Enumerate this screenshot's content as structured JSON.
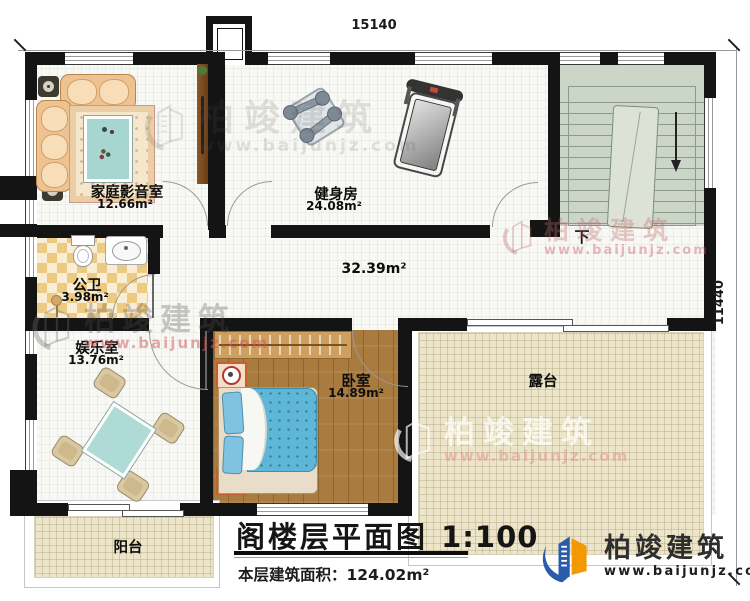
{
  "dimensions": {
    "top": "15140",
    "right": "11440"
  },
  "rooms": {
    "theater": {
      "name": "家庭影音室",
      "area": "12.66m²"
    },
    "gym": {
      "name": "健身房",
      "area": "24.08m²"
    },
    "bath": {
      "name": "公卫",
      "area": "3.98m²"
    },
    "play": {
      "name": "娱乐室",
      "area": "13.76m²"
    },
    "bedroom": {
      "name": "卧室",
      "area": "14.89m²"
    },
    "terrace": {
      "name": "露台"
    },
    "balcony": {
      "name": "阳台"
    },
    "hall": {
      "area": "32.39m²"
    },
    "stair": {
      "label": "下"
    }
  },
  "title_block": {
    "title": "阁楼层平面图",
    "scale": "1:100",
    "area_label": "本层建筑面积：",
    "area_value": "124.02m²"
  },
  "brand": {
    "name": "柏竣建筑",
    "url": "www.baijunjz.com"
  }
}
